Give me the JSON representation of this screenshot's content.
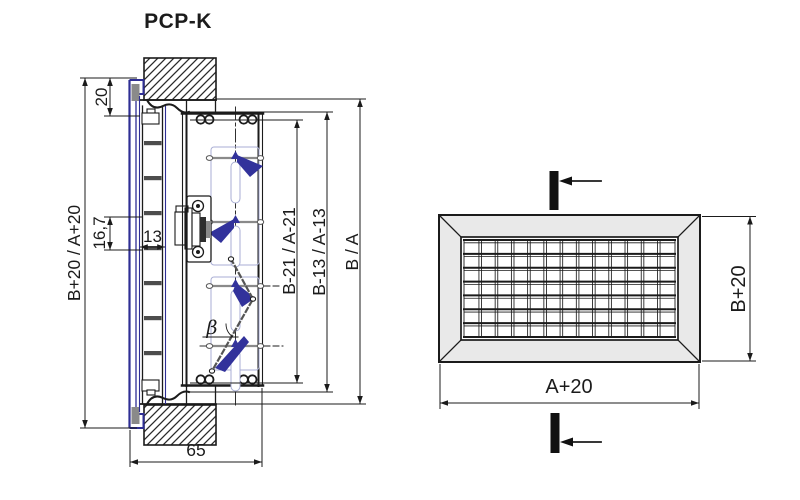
{
  "product": {
    "title": "PCP-K"
  },
  "section_view": {
    "dim_overall": "B+20 / A+20",
    "dim_frame_flange": "20",
    "dim_blade_pitch": "16,7",
    "dim_blade_width": "13",
    "dim_inner_minus21": "B-21 / A-21",
    "dim_inner_minus13": "B-13 / A-13",
    "dim_duct": "B / A",
    "dim_depth": "65",
    "angle_symbol": "β",
    "front_blade_count": 7,
    "damper_count": 4
  },
  "front_view": {
    "dim_width": "A+20",
    "dim_height": "B+20",
    "grid_cols": 13,
    "grid_rows": 7
  },
  "colors": {
    "line": "#1b1b1b",
    "profile_blue": "#2e2e94",
    "blade_blue": "#32329b",
    "guide_blue": "#a9aed4",
    "frame_fill": "#e9e9e9",
    "metal_gray": "#8a8a8a"
  }
}
